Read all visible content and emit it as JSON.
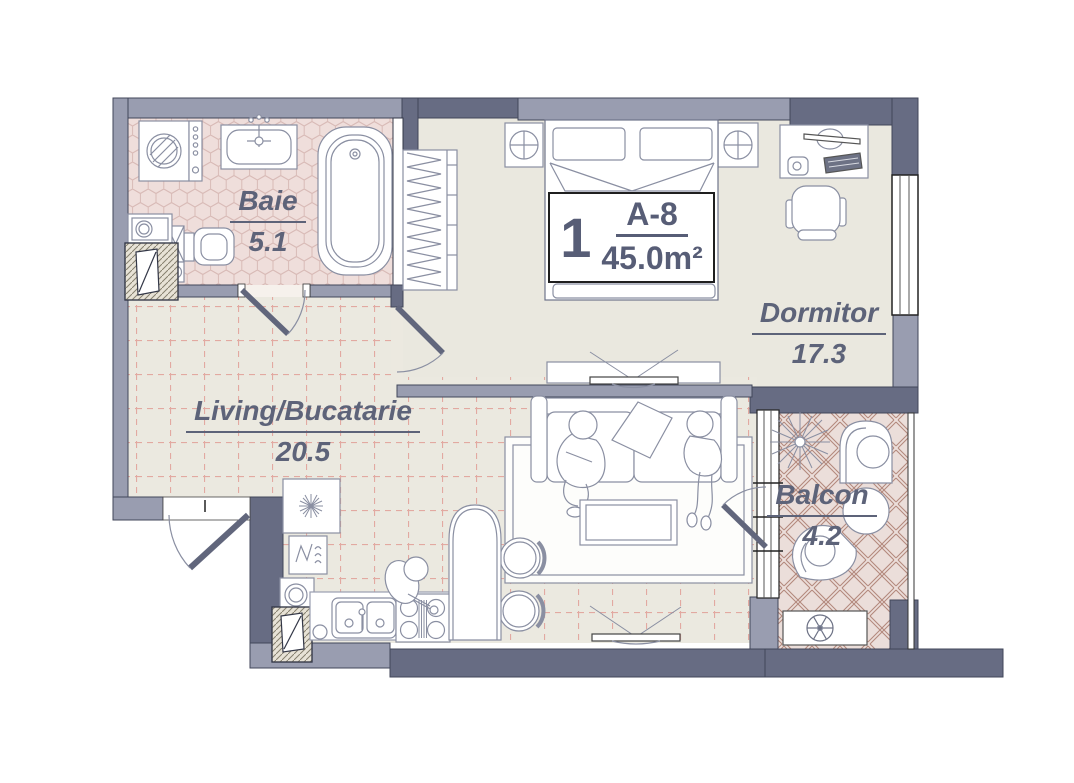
{
  "unit": {
    "number": "1",
    "code": "A-8",
    "area": "45.0m²"
  },
  "rooms": [
    {
      "name": "Baie",
      "area": "5.1"
    },
    {
      "name": "Dormitor",
      "area": "17.3"
    },
    {
      "name": "Living/Bucatarie",
      "area": "20.5"
    },
    {
      "name": "Balcon",
      "area": "4.2"
    }
  ],
  "colors": {
    "wall_light": "#999db0",
    "wall_dark": "#676c83",
    "floor_beige": "#ebe9e0",
    "bath_tile_base": "#efdedb",
    "bath_tile_line": "#d8bab6",
    "balcony_tile_base": "#ebdeda",
    "balcony_tile_line": "#b3897d",
    "living_grid_line": "#e2a9a1",
    "furniture_stroke": "#8a8fa2",
    "label_text": "#5d6379"
  }
}
